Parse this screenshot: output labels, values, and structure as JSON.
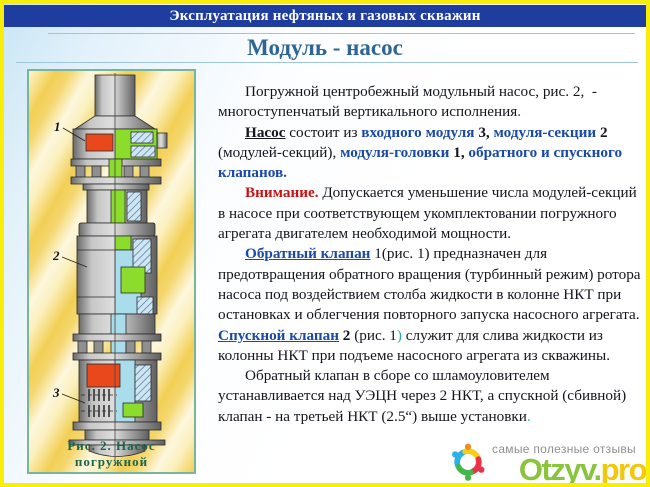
{
  "header": {
    "title": "Эксплуатация нефтяных и газовых скважин"
  },
  "slide": {
    "title": "Модуль - насос"
  },
  "figure": {
    "caption": "Рис. 2. Насос погружной",
    "label_1": "1",
    "label_2": "2",
    "label_3": "3"
  },
  "content": {
    "p1": [
      {
        "t": "Погружной центробежный модульный насос, рис. 2,  - многоступенчатый вертикального исполнения",
        "s": ""
      },
      {
        "t": ".",
        "s": "bl"
      }
    ],
    "p2": [
      {
        "t": "Насос",
        "s": "bu"
      },
      {
        "t": " состоит из ",
        "s": ""
      },
      {
        "t": "входного модуля ",
        "s": "bb"
      },
      {
        "t": "3, ",
        "s": "bk"
      },
      {
        "t": "модуля-секции ",
        "s": "bb"
      },
      {
        "t": "2",
        "s": "bk"
      },
      {
        "t": " (модулей-секций), ",
        "s": ""
      },
      {
        "t": "модуля-головки ",
        "s": "bb"
      },
      {
        "t": "1, ",
        "s": "bk"
      },
      {
        "t": "обратного и спускного клапанов.",
        "s": "bb"
      }
    ],
    "p3": [
      {
        "t": "Внимание.",
        "s": "rd"
      },
      {
        "t": " Допускается уменьшение числа модулей-секций в насосе при соответствующем укомплектовании погружного агрегата двигателем необходимой мощности.",
        "s": ""
      }
    ],
    "p4": [
      {
        "t": "Обратный клапан",
        "s": "lb"
      },
      {
        "t": " 1(рис. 1) предназначен для предотвращения обратного вращения (турбинный режим) ротора насоса под воздействием столба жидкости в колонне НКТ при остановках и облегчения повторного запуска насосного агрегата. ",
        "s": ""
      },
      {
        "t": "Спускной клапан",
        "s": "lb"
      },
      {
        "t": " ",
        "s": ""
      },
      {
        "t": "2",
        "s": "bk"
      },
      {
        "t": " (рис. 1",
        "s": ""
      },
      {
        "t": ")",
        "s": "tl"
      },
      {
        "t": " служит для слива жидкости из колонны НКТ при подъеме насосного агрегата из скважины.",
        "s": ""
      }
    ],
    "p5": [
      {
        "t": "Обратный клапан в сборе со шламоуловителем устанавливается над УЭЦН через 2 НКТ, а спускной (сбивной) клапан - на третьей НКТ (2.5“) выше установки",
        "s": ""
      },
      {
        "t": ".",
        "s": "tl"
      }
    ]
  },
  "footer": {
    "tagline": "самые полезные отзывы",
    "brand_green": "Otzyv.",
    "brand_yellow": "pro"
  },
  "colors": {
    "header_bar": "#1e3d9e",
    "slide_border": "#f8ee0a",
    "title_blue": "#2d6595",
    "accent_blue": "#1b49a8",
    "attention_red": "#c41414",
    "teal_accent": "#2ba3a8",
    "caption_green": "#1a6450",
    "figure_frame": "#79b49c",
    "pump_green": "#8bdc2c",
    "pump_cyan": "#a9ddec",
    "pump_orange": "#e8481c",
    "brand_green": "#8ac43c",
    "brand_yellow": "#f3c80c"
  }
}
